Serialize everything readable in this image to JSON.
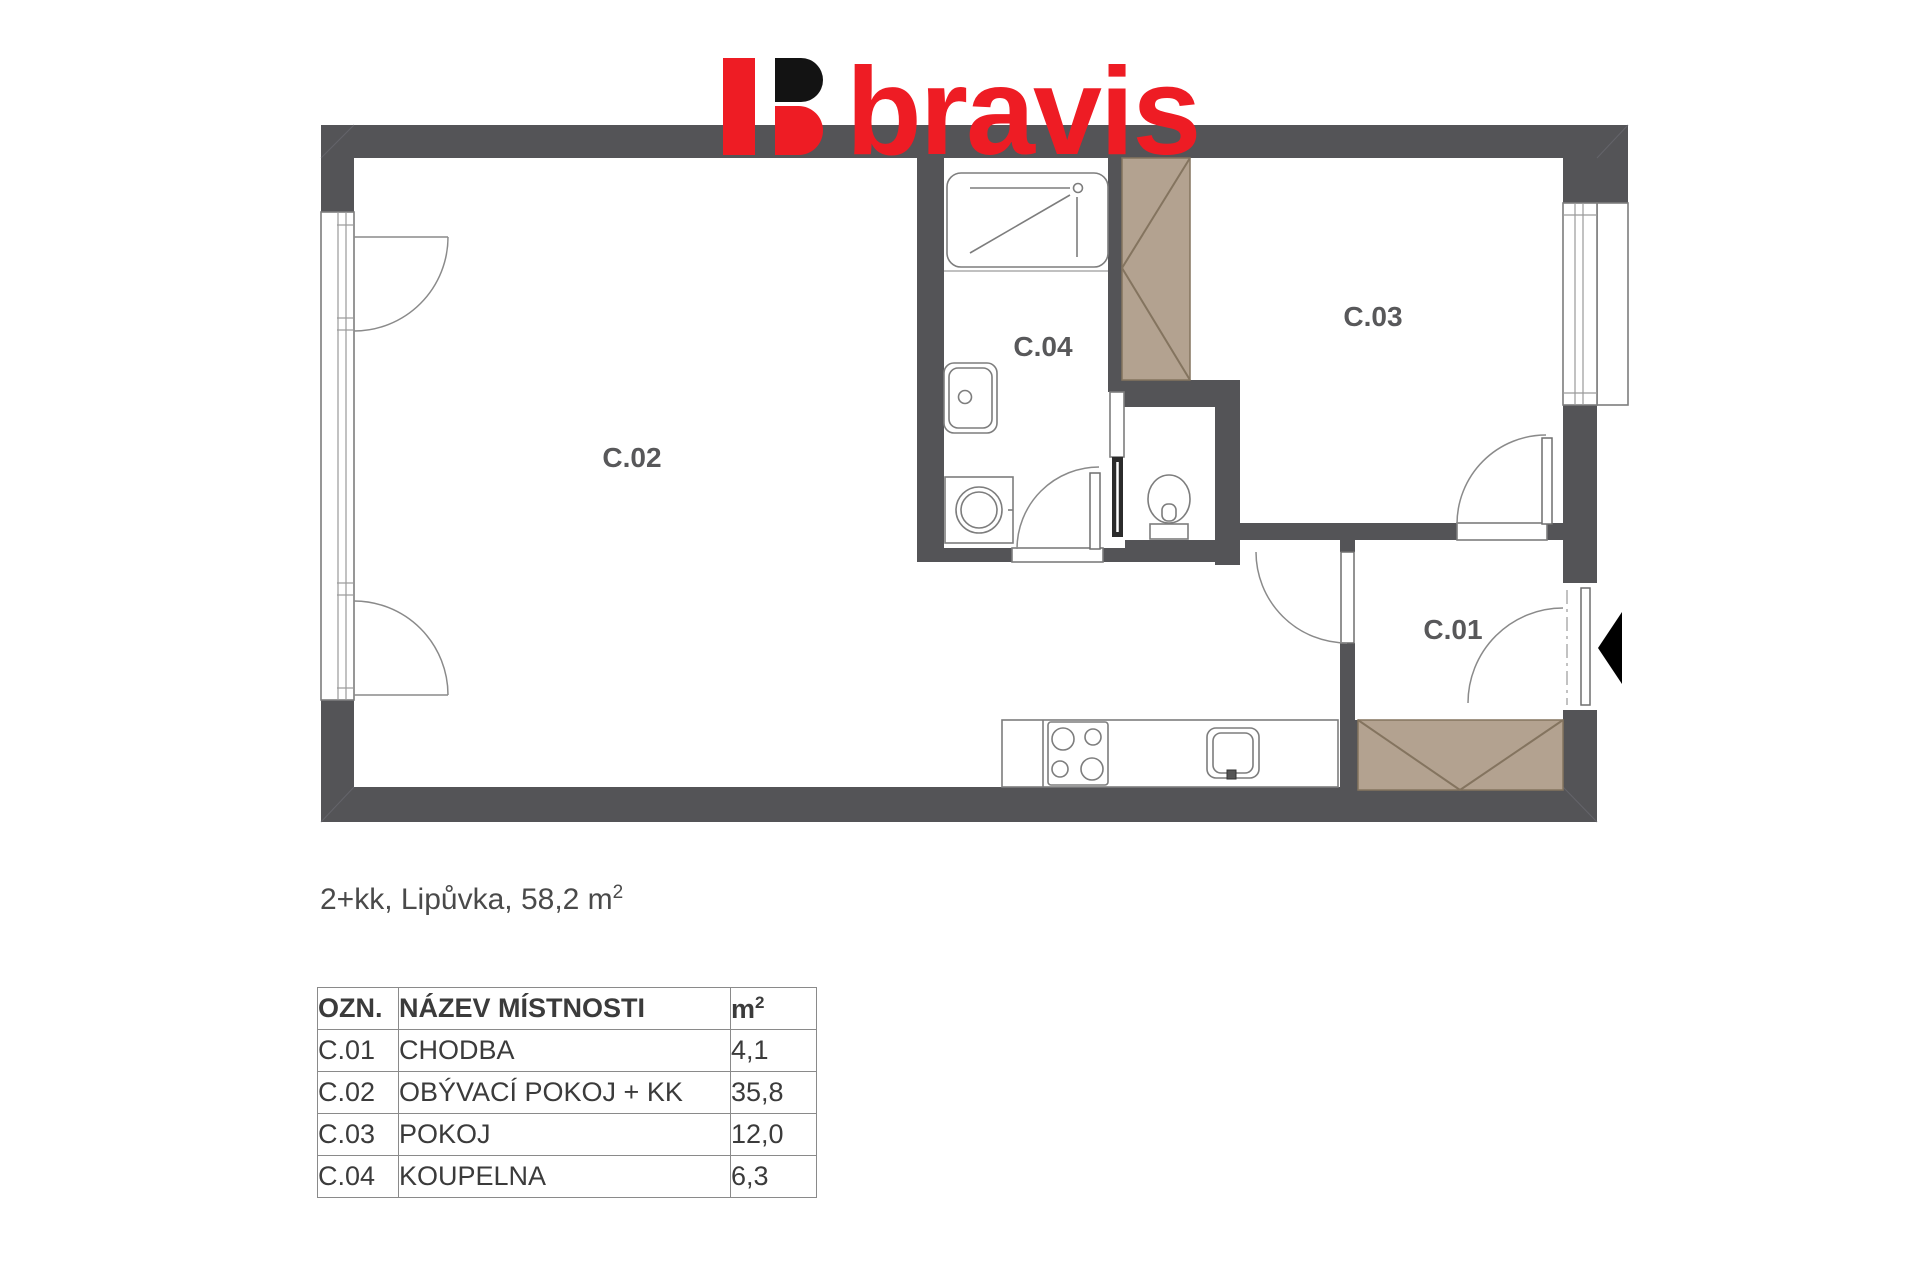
{
  "colors": {
    "wall": "#545457",
    "tan": "#b3a290",
    "tanline": "#84745f",
    "red": "#ee1c24",
    "dark": "#131313",
    "line": "#8a8a8a",
    "label": "#58585a"
  },
  "logo": {
    "text": "bravis"
  },
  "plan": {
    "labels": {
      "c01": "C.01",
      "c02": "C.02",
      "c03": "C.03",
      "c04": "C.04"
    }
  },
  "caption": {
    "text": "2+kk, Lipůvka, 58,2 m",
    "sup": "2"
  },
  "table": {
    "headers": {
      "ozn": "OZN.",
      "nazev": "NÁZEV MÍSTNOSTI",
      "m2": "m",
      "m2_sup": "2"
    },
    "rows": [
      {
        "ozn": "C.01",
        "nazev": "CHODBA",
        "area": "4,1"
      },
      {
        "ozn": "C.02",
        "nazev": "OBÝVACÍ POKOJ + KK",
        "area": "35,8"
      },
      {
        "ozn": "C.03",
        "nazev": "POKOJ",
        "area": "12,0"
      },
      {
        "ozn": "C.04",
        "nazev": "KOUPELNA",
        "area": "6,3"
      }
    ]
  }
}
